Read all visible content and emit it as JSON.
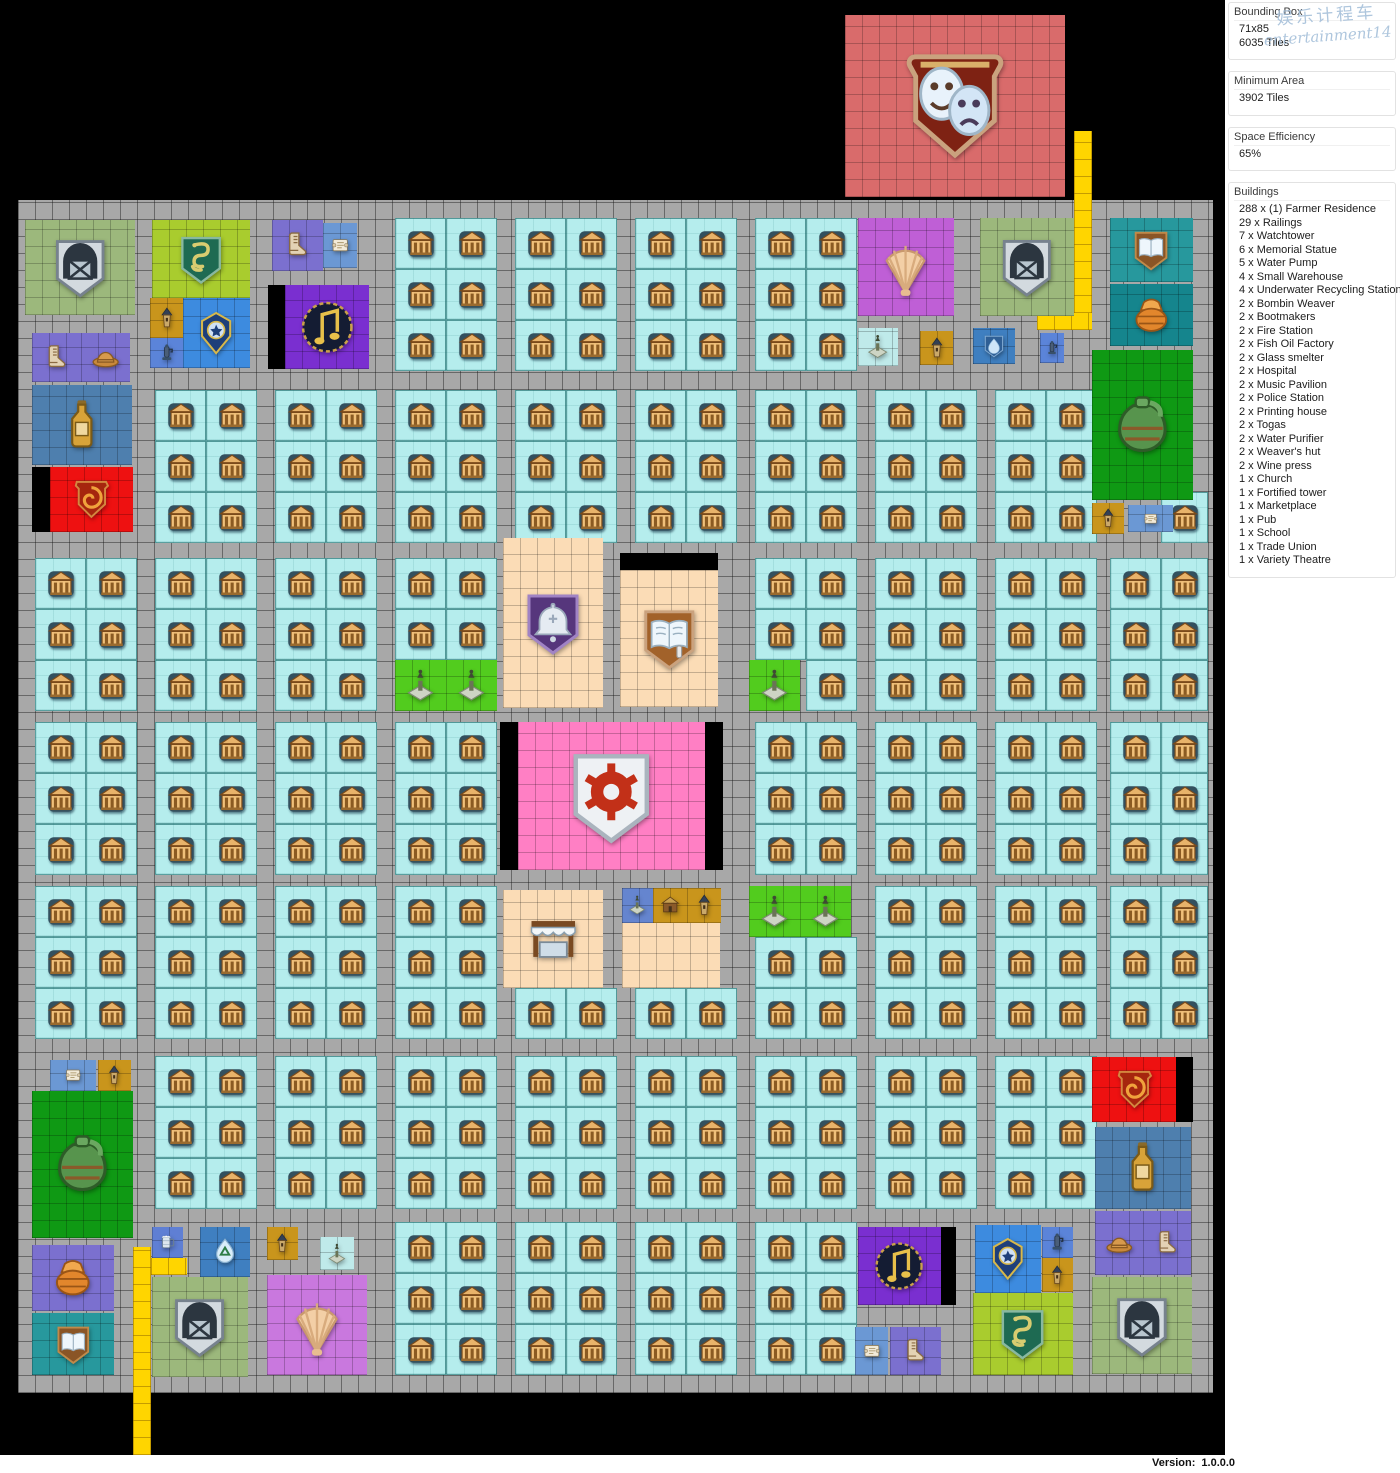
{
  "watermark": {
    "line1": "娱乐计程车",
    "line2": "entertainment14"
  },
  "sidebar": {
    "sections": [
      {
        "title": "Bounding Box",
        "lines": [
          "71x85",
          "6035 Tiles"
        ]
      },
      {
        "title": "Minimum Area",
        "lines": [
          "3902 Tiles"
        ]
      },
      {
        "title": "Space Efficiency",
        "lines": [
          "65%"
        ]
      },
      {
        "title": "Buildings",
        "lines": [
          "288 x (1) Farmer Residence",
          "29 x Railings",
          "7 x Watchtower",
          "6 x Memorial Statue",
          "5 x Water Pump",
          "4 x Small Warehouse",
          "4 x Underwater Recycling Station",
          "2 x Bombin Weaver",
          "2 x Bootmakers",
          "2 x Fire Station",
          "2 x Fish Oil Factory",
          "2 x Glass smelter",
          "2 x Hospital",
          "2 x Music Pavilion",
          "2 x Police Station",
          "2 x Printing house",
          "2 x Togas",
          "2 x Water Purifier",
          "2 x Weaver's hut",
          "2 x Wine press",
          "1 x Church",
          "1 x Fortified tower",
          "1 x Marketplace",
          "1 x Pub",
          "1 x School",
          "1 x Trade Union",
          "1 x Variety Theatre"
        ]
      }
    ]
  },
  "statusbar": {
    "version_label": "Version:",
    "version": "1.0.0.0"
  },
  "map": {
    "palette": {
      "road": "#a8a8a8",
      "cyan": "#b5eded",
      "yellow": "#ffd500",
      "black": "#000000",
      "sage": "#9cb87c",
      "lime": "#a9cc2e",
      "violet": "#7b70cf",
      "blue": "#3d8bdf",
      "steel": "#4e7fae",
      "purple": "#7a2fd0",
      "gold": "#c9951c",
      "pumpblue": "#5b84d9",
      "red": "#ee1111",
      "orchid": "#bf5fd6",
      "orchid2": "#c978de",
      "teal": "#27989d",
      "teal2": "#15858d",
      "peach": "#fbdcb6",
      "pink": "#ff7fc4",
      "wine": "#0f9914",
      "memgreen": "#52cc1e",
      "memcyan": "#bfeaea",
      "memblue": "#6585cf",
      "scrollblue": "#6b98d4",
      "tankblue": "#5f7fd4",
      "purif": "#3f7fc0",
      "theatre": "#d96b6b"
    },
    "city": {
      "x": 18,
      "y": 200,
      "w": 1195,
      "h": 1193
    },
    "residential": {
      "columns": [
        35,
        155,
        275,
        395,
        515,
        635,
        755,
        875,
        995,
        1110
      ],
      "bands": [
        218,
        390,
        558,
        722,
        886,
        1056,
        1222
      ],
      "cell": 51,
      "block_cols": 2,
      "block_rows": 3,
      "right_limit": 1208
    },
    "specials": [
      {
        "n": "variety-theatre",
        "i": "masks",
        "c": "theatre",
        "x": 845,
        "y": 15,
        "w": 220,
        "h": 182
      },
      {
        "n": "railings",
        "i": null,
        "c": "yellow",
        "x": 1074,
        "y": 131,
        "w": 18,
        "h": 199
      },
      {
        "n": "railings",
        "i": null,
        "c": "yellow",
        "x": 1037,
        "y": 313,
        "w": 55,
        "h": 17
      },
      {
        "n": "small-warehouse",
        "i": "warehouse",
        "c": "sage",
        "x": 25,
        "y": 220,
        "w": 110,
        "h": 95
      },
      {
        "n": "bootmakers",
        "i": "boots",
        "c": "violet",
        "x": 32,
        "y": 333,
        "w": 49,
        "h": 49
      },
      {
        "n": "bombin-weaver",
        "i": "hat",
        "c": "violet",
        "x": 81,
        "y": 333,
        "w": 49,
        "h": 49
      },
      {
        "n": "fish-oil-factory",
        "i": "bottle",
        "c": "steel",
        "x": 32,
        "y": 385,
        "w": 100,
        "h": 80
      },
      {
        "n": "black-tile",
        "i": null,
        "c": "black",
        "x": 32,
        "y": 467,
        "w": 18,
        "h": 65
      },
      {
        "n": "fire-station",
        "i": "firespiral",
        "c": "red",
        "x": 50,
        "y": 467,
        "w": 83,
        "h": 65
      },
      {
        "n": "hospital",
        "i": "snake",
        "c": "lime",
        "x": 152,
        "y": 220,
        "w": 98,
        "h": 78
      },
      {
        "n": "watchtower",
        "i": "tower",
        "c": "gold",
        "x": 150,
        "y": 298,
        "w": 33,
        "h": 40
      },
      {
        "n": "water-pump",
        "i": "pump",
        "c": "pumpblue",
        "x": 150,
        "y": 338,
        "w": 33,
        "h": 30
      },
      {
        "n": "police-station",
        "i": "badge",
        "c": "blue",
        "x": 183,
        "y": 298,
        "w": 67,
        "h": 70
      },
      {
        "n": "bootmakers",
        "i": "boots",
        "c": "violet",
        "x": 272,
        "y": 220,
        "w": 51,
        "h": 51
      },
      {
        "n": "weavers-hut",
        "i": "scroll",
        "c": "scrollblue",
        "x": 323,
        "y": 223,
        "w": 34,
        "h": 45
      },
      {
        "n": "black-tile",
        "i": null,
        "c": "black",
        "x": 268,
        "y": 285,
        "w": 17,
        "h": 84
      },
      {
        "n": "music-pavilion",
        "i": "note",
        "c": "purple",
        "x": 285,
        "y": 285,
        "w": 84,
        "h": 84
      },
      {
        "n": "underwater-recycling-station",
        "i": "shell",
        "c": "orchid",
        "x": 858,
        "y": 218,
        "w": 96,
        "h": 98
      },
      {
        "n": "small-warehouse",
        "i": "warehouse",
        "c": "sage",
        "x": 980,
        "y": 218,
        "w": 94,
        "h": 98
      },
      {
        "n": "printing-house",
        "i": "book",
        "c": "teal",
        "x": 1110,
        "y": 218,
        "w": 83,
        "h": 64
      },
      {
        "n": "glass-smelter",
        "i": "basket",
        "c": "teal2",
        "x": 1110,
        "y": 284,
        "w": 83,
        "h": 62
      },
      {
        "n": "memorial-statue",
        "i": "statue",
        "c": "memcyan",
        "x": 858,
        "y": 328,
        "w": 40,
        "h": 38
      },
      {
        "n": "watchtower",
        "i": "tower",
        "c": "gold",
        "x": 920,
        "y": 331,
        "w": 33,
        "h": 34
      },
      {
        "n": "water-purifier",
        "i": "drop",
        "c": "purif",
        "x": 973,
        "y": 328,
        "w": 42,
        "h": 36
      },
      {
        "n": "water-pump",
        "i": "pump",
        "c": "pumpblue",
        "x": 1040,
        "y": 333,
        "w": 24,
        "h": 30
      },
      {
        "n": "wine-press",
        "i": "jug",
        "c": "wine",
        "x": 1092,
        "y": 350,
        "w": 101,
        "h": 150
      },
      {
        "n": "watchtower",
        "i": "tower",
        "c": "gold",
        "x": 1092,
        "y": 503,
        "w": 32,
        "h": 31
      },
      {
        "n": "weavers-hut",
        "i": "scroll",
        "c": "scrollblue",
        "x": 1128,
        "y": 505,
        "w": 45,
        "h": 27
      },
      {
        "n": "church",
        "i": "bell",
        "c": "peach",
        "x": 503,
        "y": 538,
        "w": 100,
        "h": 170
      },
      {
        "n": "black-tile",
        "i": null,
        "c": "black",
        "x": 620,
        "y": 553,
        "w": 98,
        "h": 17
      },
      {
        "n": "school",
        "i": "book2",
        "c": "peach",
        "x": 620,
        "y": 570,
        "w": 98,
        "h": 137
      },
      {
        "n": "memorial-statue",
        "i": "statue",
        "c": "memgreen",
        "x": 395,
        "y": 660,
        "w": 51,
        "h": 51
      },
      {
        "n": "memorial-statue",
        "i": "statue",
        "c": "memgreen",
        "x": 446,
        "y": 660,
        "w": 51,
        "h": 51
      },
      {
        "n": "memorial-statue",
        "i": "statue",
        "c": "memgreen",
        "x": 749,
        "y": 660,
        "w": 51,
        "h": 51
      },
      {
        "n": "black-tile",
        "i": null,
        "c": "black",
        "x": 500,
        "y": 722,
        "w": 18,
        "h": 148
      },
      {
        "n": "trade-union",
        "i": "gear",
        "c": "pink",
        "x": 518,
        "y": 722,
        "w": 187,
        "h": 148
      },
      {
        "n": "black-tile",
        "i": null,
        "c": "black",
        "x": 705,
        "y": 722,
        "w": 18,
        "h": 148
      },
      {
        "n": "marketplace",
        "i": "awning",
        "c": "peach",
        "x": 503,
        "y": 890,
        "w": 100,
        "h": 98
      },
      {
        "n": "memorial-statue",
        "i": "statue",
        "c": "memblue",
        "x": 622,
        "y": 888,
        "w": 31,
        "h": 35
      },
      {
        "n": "fortified-tower",
        "i": "stall",
        "c": "gold",
        "x": 653,
        "y": 888,
        "w": 34,
        "h": 35
      },
      {
        "n": "watchtower",
        "i": "tower",
        "c": "gold",
        "x": 687,
        "y": 888,
        "w": 34,
        "h": 35
      },
      {
        "n": "pub",
        "i": "beer",
        "c": "peach",
        "x": 622,
        "y": 923,
        "w": 98,
        "h": 65
      },
      {
        "n": "memorial-statue",
        "i": "statue",
        "c": "memgreen",
        "x": 749,
        "y": 886,
        "w": 51,
        "h": 51
      },
      {
        "n": "memorial-statue",
        "i": "statue",
        "c": "memgreen",
        "x": 800,
        "y": 886,
        "w": 51,
        "h": 51
      },
      {
        "n": "weavers-hut",
        "i": "scroll",
        "c": "scrollblue",
        "x": 50,
        "y": 1060,
        "w": 46,
        "h": 31
      },
      {
        "n": "watchtower",
        "i": "tower",
        "c": "gold",
        "x": 98,
        "y": 1060,
        "w": 33,
        "h": 31
      },
      {
        "n": "wine-press",
        "i": "jug",
        "c": "wine",
        "x": 32,
        "y": 1091,
        "w": 101,
        "h": 147
      },
      {
        "n": "fire-station",
        "i": "firespiral",
        "c": "red",
        "x": 1092,
        "y": 1057,
        "w": 84,
        "h": 65
      },
      {
        "n": "black-tile",
        "i": null,
        "c": "black",
        "x": 1176,
        "y": 1057,
        "w": 17,
        "h": 65
      },
      {
        "n": "fish-oil-factory",
        "i": "bottle",
        "c": "steel",
        "x": 1095,
        "y": 1127,
        "w": 96,
        "h": 82
      },
      {
        "n": "bombin-weaver",
        "i": "hat",
        "c": "violet",
        "x": 1095,
        "y": 1211,
        "w": 48,
        "h": 64
      },
      {
        "n": "bootmakers",
        "i": "boots",
        "c": "violet",
        "x": 1143,
        "y": 1211,
        "w": 48,
        "h": 64
      },
      {
        "n": "small-warehouse",
        "i": "warehouse",
        "c": "sage",
        "x": 1092,
        "y": 1277,
        "w": 100,
        "h": 97
      },
      {
        "n": "bombin-weaver",
        "i": "basket",
        "c": "violet",
        "x": 32,
        "y": 1245,
        "w": 82,
        "h": 66
      },
      {
        "n": "printing-house",
        "i": "book",
        "c": "teal",
        "x": 32,
        "y": 1313,
        "w": 82,
        "h": 62
      },
      {
        "n": "railings",
        "i": null,
        "c": "yellow",
        "x": 133,
        "y": 1247,
        "w": 18,
        "h": 208
      },
      {
        "n": "railings",
        "i": null,
        "c": "yellow",
        "x": 151,
        "y": 1258,
        "w": 36,
        "h": 17
      },
      {
        "n": "pub-tankard",
        "i": "tankard",
        "c": "tankblue",
        "x": 152,
        "y": 1227,
        "w": 31,
        "h": 31
      },
      {
        "n": "underwater-recycling-station",
        "i": "recycle",
        "c": "purif",
        "x": 200,
        "y": 1227,
        "w": 50,
        "h": 50
      },
      {
        "n": "watchtower",
        "i": "tower",
        "c": "gold",
        "x": 267,
        "y": 1227,
        "w": 31,
        "h": 33
      },
      {
        "n": "memorial-statue",
        "i": "statue",
        "c": "memcyan",
        "x": 320,
        "y": 1237,
        "w": 34,
        "h": 33
      },
      {
        "n": "small-warehouse",
        "i": "warehouse",
        "c": "sage",
        "x": 152,
        "y": 1277,
        "w": 96,
        "h": 100
      },
      {
        "n": "underwater-recycling-station",
        "i": "shell",
        "c": "orchid2",
        "x": 267,
        "y": 1275,
        "w": 100,
        "h": 100
      },
      {
        "n": "music-pavilion",
        "i": "note",
        "c": "purple",
        "x": 858,
        "y": 1227,
        "w": 83,
        "h": 78
      },
      {
        "n": "black-tile",
        "i": null,
        "c": "black",
        "x": 941,
        "y": 1227,
        "w": 15,
        "h": 78
      },
      {
        "n": "police-station",
        "i": "badge",
        "c": "blue",
        "x": 975,
        "y": 1225,
        "w": 66,
        "h": 68
      },
      {
        "n": "water-pump",
        "i": "pump",
        "c": "pumpblue",
        "x": 1042,
        "y": 1227,
        "w": 31,
        "h": 31
      },
      {
        "n": "watchtower",
        "i": "tower",
        "c": "gold",
        "x": 1042,
        "y": 1258,
        "w": 31,
        "h": 34
      },
      {
        "n": "hospital",
        "i": "snake",
        "c": "lime",
        "x": 973,
        "y": 1293,
        "w": 100,
        "h": 82
      },
      {
        "n": "weavers-hut",
        "i": "scroll",
        "c": "scrollblue",
        "x": 855,
        "y": 1327,
        "w": 33,
        "h": 48
      },
      {
        "n": "bootmakers",
        "i": "boots",
        "c": "violet",
        "x": 890,
        "y": 1327,
        "w": 51,
        "h": 48
      }
    ]
  }
}
